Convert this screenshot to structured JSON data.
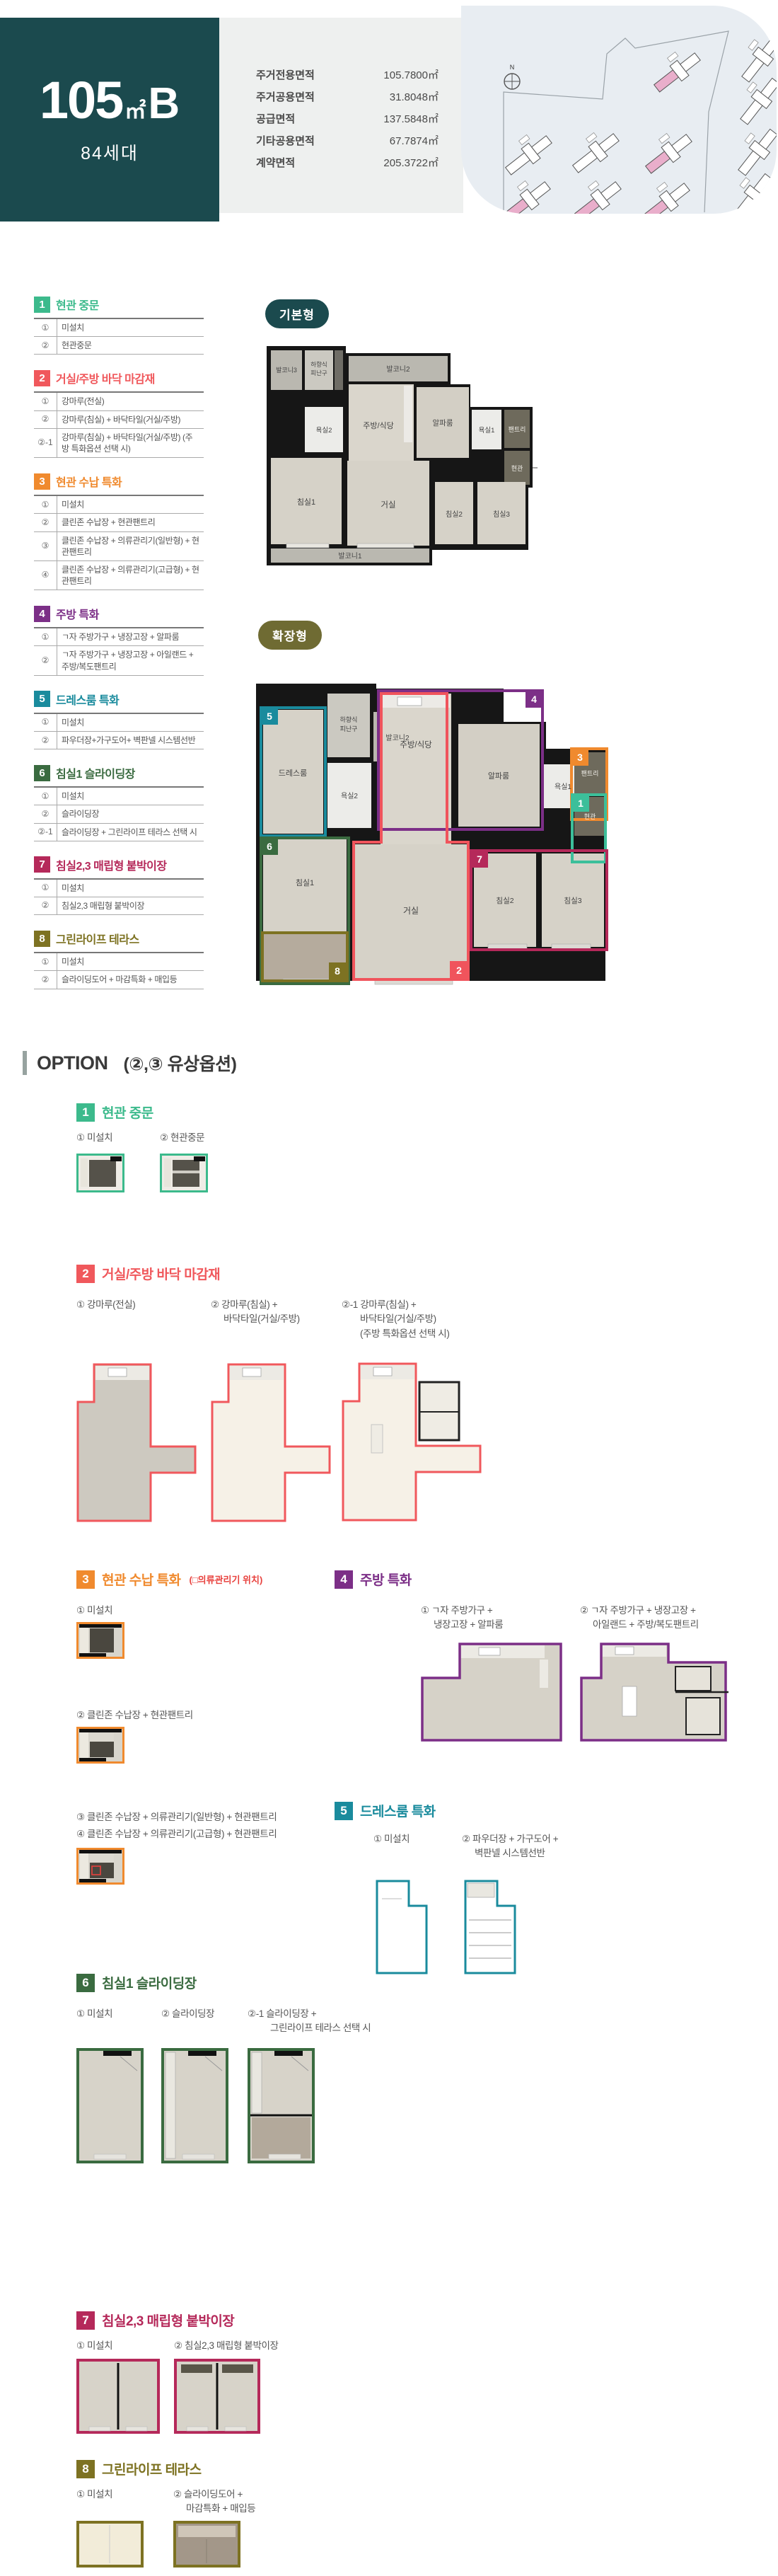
{
  "header": {
    "unit_name_num": "105",
    "unit_name_unit": "㎡",
    "unit_name_suffix": "B",
    "households": "84세대",
    "teal": "#1b4a4e",
    "area_table": [
      {
        "label": "주거전용면적",
        "value": "105.7800㎡"
      },
      {
        "label": "주거공용면적",
        "value": "31.8048㎡"
      },
      {
        "label": "공급면적",
        "value": "137.5848㎡"
      },
      {
        "label": "기타공용면적",
        "value": "67.7874㎡"
      },
      {
        "label": "계약면적",
        "value": "205.3722㎡"
      }
    ],
    "compass": "N",
    "site_pink": "#e9aecb"
  },
  "plans": {
    "basic_badge": "기본형",
    "basic_badge_color": "#1b4a4e",
    "extended_badge": "확장형",
    "extended_badge_color": "#6f6b33",
    "rooms": {
      "balcony1": "발코니1",
      "balcony2": "발코니2",
      "balcony3": "발코니3",
      "escape1": "하향식",
      "escape2": "피난구",
      "bath1": "욕실1",
      "bath2": "욕실2",
      "kitchen": "주방/식당",
      "alpha": "알파룸",
      "pantry": "팬트리",
      "entry": "현관",
      "bed1": "침실1",
      "bed2": "침실2",
      "bed3": "침실3",
      "living": "거실",
      "dress": "드레스룸"
    },
    "overlays": [
      {
        "num": "1",
        "color": "#3cbf9a"
      },
      {
        "num": "2",
        "color": "#f0545c"
      },
      {
        "num": "3",
        "color": "#f08a2e"
      },
      {
        "num": "4",
        "color": "#7c2f87"
      },
      {
        "num": "5",
        "color": "#1a8b9d"
      },
      {
        "num": "6",
        "color": "#3a6b40"
      },
      {
        "num": "7",
        "color": "#b5295a"
      },
      {
        "num": "8",
        "color": "#7d7222"
      }
    ]
  },
  "sidebar": {
    "sections": [
      {
        "num": "1",
        "title": "현관 중문",
        "color": "#3cba8c",
        "rows": [
          {
            "mark": "①",
            "text": "미설치"
          },
          {
            "mark": "②",
            "text": "현관중문"
          }
        ]
      },
      {
        "num": "2",
        "title": "거실/주방 바닥 마감재",
        "color": "#f0585c",
        "rows": [
          {
            "mark": "①",
            "text": "강마루(전실)"
          },
          {
            "mark": "②",
            "text": "강마루(침실) + 바닥타일(거실/주방)"
          },
          {
            "mark": "②-1",
            "text": "강마루(침실) + 바닥타일(거실/주방) (주방 특화옵션 선택 시)"
          }
        ]
      },
      {
        "num": "3",
        "title": "현관 수납 특화",
        "color": "#f08a2e",
        "rows": [
          {
            "mark": "①",
            "text": "미설치"
          },
          {
            "mark": "②",
            "text": "클린존 수납장 + 현관팬트리"
          },
          {
            "mark": "③",
            "text": "클린존 수납장 + 의류관리기(일반형) + 현관팬트리"
          },
          {
            "mark": "④",
            "text": "클린존 수납장 + 의류관리기(고급형) + 현관팬트리"
          }
        ]
      },
      {
        "num": "4",
        "title": "주방 특화",
        "color": "#7c2f87",
        "rows": [
          {
            "mark": "①",
            "text": "ㄱ자 주방가구 + 냉장고장 + 알파룸"
          },
          {
            "mark": "②",
            "text": "ㄱ자 주방가구 + 냉장고장 + 아일랜드 + 주방/복도팬트리"
          }
        ]
      },
      {
        "num": "5",
        "title": "드레스룸 특화",
        "color": "#1a8b9d",
        "rows": [
          {
            "mark": "①",
            "text": "미설치"
          },
          {
            "mark": "②",
            "text": "파우더장+가구도어+ 벽판넬 시스템선반"
          }
        ]
      },
      {
        "num": "6",
        "title": "침실1 슬라이딩장",
        "color": "#3a6b40",
        "rows": [
          {
            "mark": "①",
            "text": "미설치"
          },
          {
            "mark": "②",
            "text": "슬라이딩장"
          },
          {
            "mark": "②-1",
            "text": "슬라이딩장 + 그린라이프 테라스 선택 시"
          }
        ]
      },
      {
        "num": "7",
        "title": "침실2,3 매립형 붙박이장",
        "color": "#b5295a",
        "rows": [
          {
            "mark": "①",
            "text": "미설치"
          },
          {
            "mark": "②",
            "text": "침실2,3 매립형 붙박이장"
          }
        ]
      },
      {
        "num": "8",
        "title": "그린라이프 테라스",
        "color": "#7d7222",
        "rows": [
          {
            "mark": "①",
            "text": "미설치"
          },
          {
            "mark": "②",
            "text": "슬라이딩도어 + 마감특화 + 매입등"
          }
        ]
      }
    ]
  },
  "options": {
    "heading": "OPTION",
    "heading_note": "(②,③ 유상옵션)",
    "sections": [
      {
        "num": "1",
        "title": "현관 중문",
        "color": "#3cba8c",
        "items": [
          {
            "lines": [
              "① 미설치"
            ]
          },
          {
            "lines": [
              "② 현관중문"
            ]
          }
        ]
      },
      {
        "num": "2",
        "title": "거실/주방 바닥 마감재",
        "color": "#f0585c",
        "items": [
          {
            "lines": [
              "① 강마루(전실)"
            ]
          },
          {
            "lines": [
              "② 강마루(침실) +",
              "바닥타일(거실/주방)"
            ]
          },
          {
            "lines": [
              "②-1 강마루(침실) +",
              "바닥타일(거실/주방)",
              "(주방 특화옵션 선택 시)"
            ]
          }
        ]
      },
      {
        "num": "3",
        "title": "현관 수납 특화",
        "note": "(□의류관리기 위치)",
        "note_color": "#e8413d",
        "color": "#f08a2e",
        "items": [
          {
            "lines": [
              "① 미설치"
            ]
          },
          {
            "lines": [
              "② 클린존 수납장 + 현관팬트리"
            ]
          },
          {
            "lines": [
              "③ 클린존 수납장 + 의류관리기(일반형) + 현관팬트리"
            ]
          },
          {
            "lines": [
              "④ 클린존 수납장 + 의류관리기(고급형) + 현관팬트리"
            ]
          }
        ]
      },
      {
        "num": "4",
        "title": "주방 특화",
        "color": "#7c2f87",
        "items": [
          {
            "lines": [
              "① ㄱ자 주방가구 +",
              "냉장고장 + 알파룸"
            ]
          },
          {
            "lines": [
              "② ㄱ자 주방가구 + 냉장고장 +",
              "아일랜드 + 주방/복도팬트리"
            ]
          }
        ]
      },
      {
        "num": "5",
        "title": "드레스룸 특화",
        "color": "#1a8b9d",
        "items": [
          {
            "lines": [
              "① 미설치"
            ]
          },
          {
            "lines": [
              "② 파우더장 + 가구도어 +",
              "벽판넬 시스템선반"
            ]
          }
        ]
      },
      {
        "num": "6",
        "title": "침실1 슬라이딩장",
        "color": "#3a6b40",
        "items": [
          {
            "lines": [
              "① 미설치"
            ]
          },
          {
            "lines": [
              "② 슬라이딩장"
            ]
          },
          {
            "lines": [
              "②-1 슬라이딩장 +",
              "그린라이프 테라스 선택 시"
            ]
          }
        ]
      },
      {
        "num": "7",
        "title": "침실2,3 매립형 붙박이장",
        "color": "#b5295a",
        "items": [
          {
            "lines": [
              "① 미설치"
            ]
          },
          {
            "lines": [
              "② 침실2,3 매립형 붙박이장"
            ]
          }
        ]
      },
      {
        "num": "8",
        "title": "그린라이프 테라스",
        "color": "#7d7222",
        "items": [
          {
            "lines": [
              "① 미설치"
            ]
          },
          {
            "lines": [
              "② 슬라이딩도어 +",
              "마감특화 + 매입등"
            ]
          }
        ]
      }
    ]
  }
}
